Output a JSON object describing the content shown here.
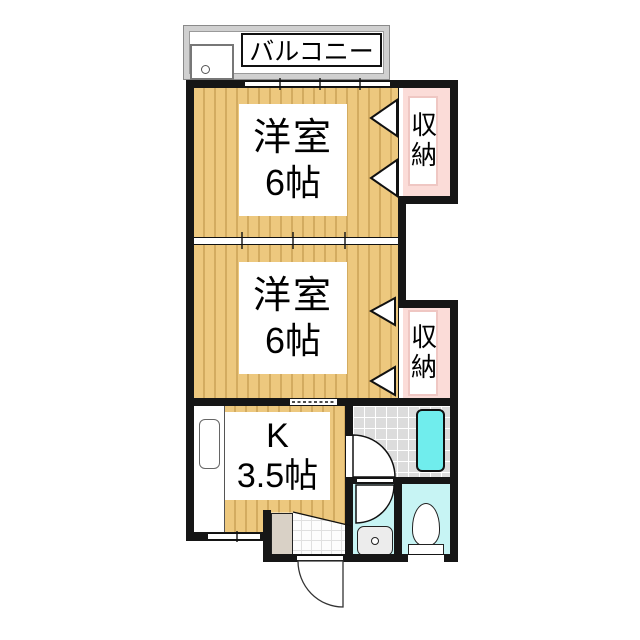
{
  "balcony": {
    "label": "バルコニー"
  },
  "rooms": {
    "western1": {
      "name": "洋室",
      "size": "6帖"
    },
    "western2": {
      "name": "洋室",
      "size": "6帖"
    },
    "kitchen": {
      "name": "K",
      "size": "3.5帖"
    },
    "closet1": {
      "label": "収納"
    },
    "closet2": {
      "label": "収納"
    }
  },
  "colors": {
    "wall": "#161616",
    "tatami_floor": "#EDC87E",
    "tatami_stripe": "#DDB25C",
    "closet_fill": "#FBDCD8",
    "closet_label_border": "#EFC7C3",
    "bathtub": "#70EDED",
    "wet_room_floor": "#C7F4F4",
    "bath_floor_tile": "#DCDCDC",
    "balcony_band": "#D0D0D0",
    "shoe_cabinet": "#D9D1C6"
  }
}
